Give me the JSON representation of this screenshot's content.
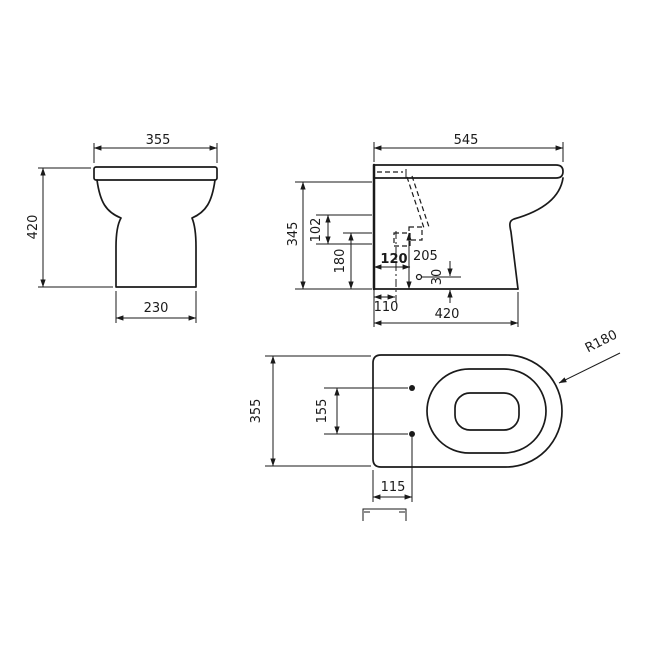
{
  "style": {
    "ink": "#1a1a1a",
    "background": "#ffffff"
  },
  "drawing": {
    "front_view": {
      "width_top": "355",
      "height_overall": "420",
      "width_base": "230"
    },
    "side_view": {
      "depth_overall": "545",
      "height_pan": "345",
      "spacing_inlets": "102",
      "height_inlet": "180",
      "setout_soil_pipe": "120",
      "height_soil_pipe": "205",
      "offset_outlet": "30",
      "setout_fixing": "110",
      "depth_base": "420"
    },
    "plan_view": {
      "width_overall": "355",
      "spacing_fixing_holes": "155",
      "setout_fixing_holes": "115",
      "radius_front": "R180"
    }
  }
}
